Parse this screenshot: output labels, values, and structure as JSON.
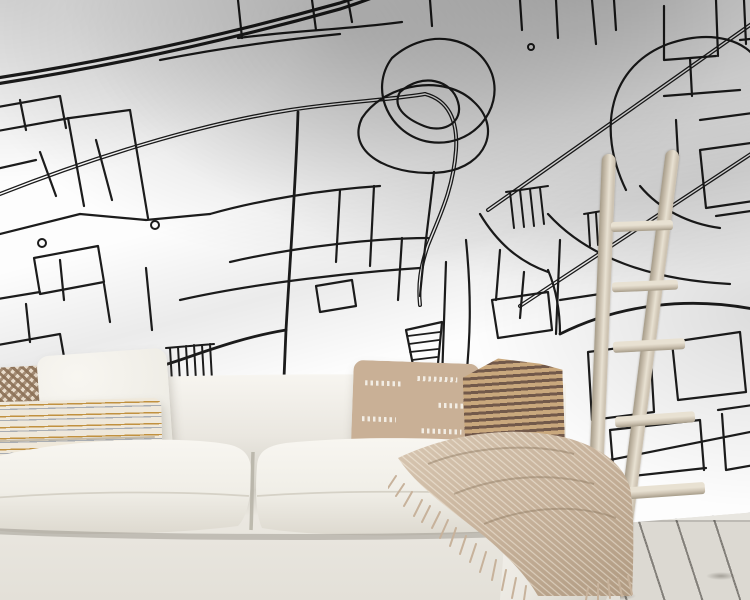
{
  "meta": {
    "scene": "interior-product-mockup-photo",
    "subject": "black-and-white city street map wall mural in a living room"
  },
  "mural": {
    "type": "city-street-map-line-art",
    "line_color": "#1c1c1c",
    "background_color": "#fdfdfd",
    "features": [
      "thick-curved-highway-top-left",
      "park-path-loops-upper-center",
      "diagonal-boulevards-top-right",
      "dense-street-grid",
      "fabric-fold-shadows"
    ]
  },
  "objects": {
    "sofa": "cream-linen-sofa-two-seat-cushions",
    "pillows": [
      "brown-checkered-pillow",
      "white-linen-pillow",
      "chevron-striped-lumbar-pillow",
      "beige-dash-pattern-pillow",
      "tan-brown-striped-pillow"
    ],
    "throw": "beige-knit-throw-with-fringe",
    "ladder": "light-wood-decor-ladder-five-rungs",
    "floor": "light-plank-floor-with-baseboard"
  },
  "palette": {
    "mapline": "#1c1c1c",
    "wallwhite": "#fdfdfd",
    "sofaivory": "#eae7e0",
    "sofashadow": "#cfccc2",
    "sofahighlight": "#f7f5f0",
    "cushionwhite": "#f0eee7",
    "checkbrown": "#8d7258",
    "checkcream": "#e9dccb",
    "pillowwhite": "#efede6",
    "chevbg": "#efe8da",
    "chevgold": "#c1913f",
    "chevgray": "#a9adb2",
    "dashbase": "#c9b096",
    "dashwhite": "#f2ede4",
    "stripelight": "#c9a87d",
    "stripedark": "#72594a",
    "throwtan": "#c7b29b",
    "throwlight": "#d8c7b2",
    "throwdark": "#b09a81",
    "ladderwood": "#cdc3b2",
    "laddershadow": "#a69c89",
    "ladderlight": "#e8e1d2",
    "floorboard": "#dcd9d2",
    "floorseam": "#83807a",
    "baseboard": "#e8e6e0"
  }
}
